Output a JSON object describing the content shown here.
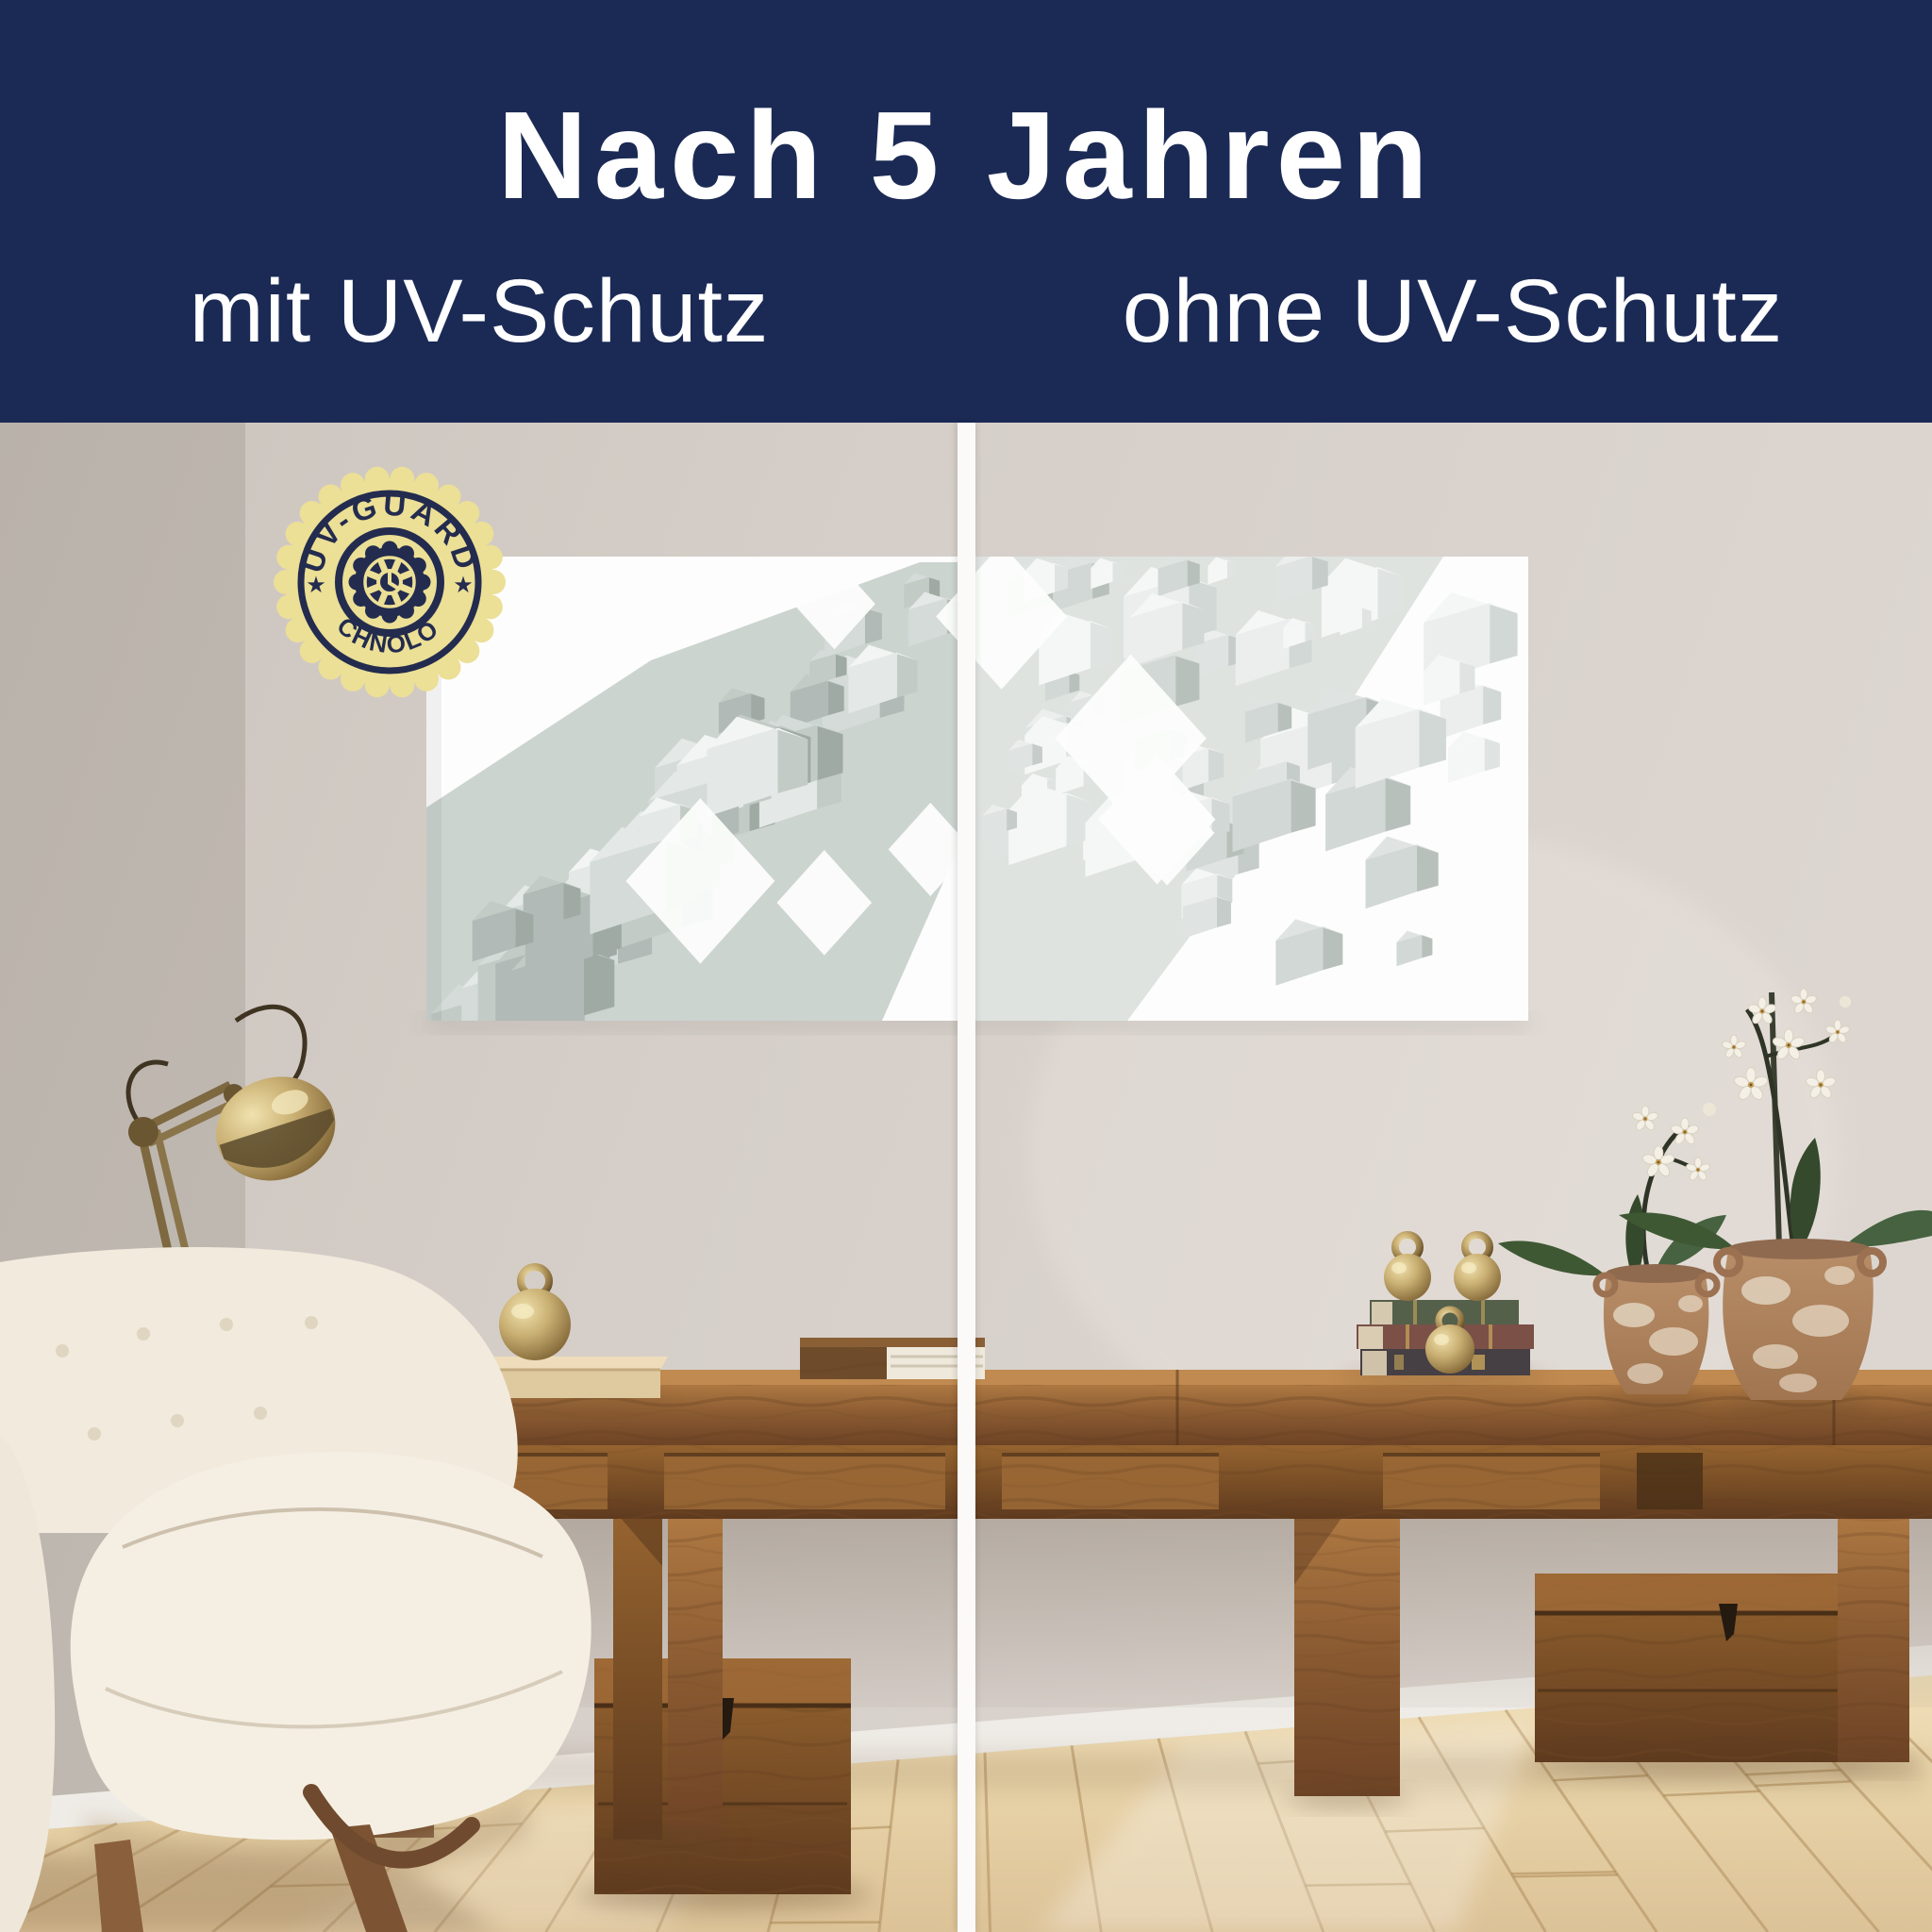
{
  "header": {
    "title": "Nach 5 Jahren",
    "left_label": "mit UV-Schutz",
    "right_label": "ohne UV-Schutz"
  },
  "badge": {
    "arc_top": "UV-GUARD",
    "arc_bottom": "TECHNOLOGY",
    "star": "★",
    "center_icon": "gear-clock-icon"
  },
  "scene_objects": {
    "artwork": "abstract-3d-cubes-diptych",
    "left_panel": "artwork-with-uv-protection",
    "right_panel": "artwork-without-uv-protection-faded",
    "room_items": [
      "boucle-armchair",
      "brass-desk-lamp",
      "wood-console-table",
      "wood-tray",
      "brass-bell",
      "book",
      "book-stack",
      "brass-ball-weights",
      "terracotta-vase-small",
      "terracotta-vase-large",
      "white-orchids",
      "wood-chest-left",
      "wood-chest-right",
      "plank-floor"
    ]
  },
  "colors": {
    "header_bg": "#1b2a55",
    "header_text": "#ffffff",
    "divider": "#fbfaf9",
    "badge_fill": "#ecdf96",
    "badge_ink": "#232c4e",
    "wall": "#d5cec8",
    "wood": "#8a5a31",
    "floor": "#e9d4ab",
    "chair": "#f2ebdf",
    "brass": "#c9af72"
  }
}
